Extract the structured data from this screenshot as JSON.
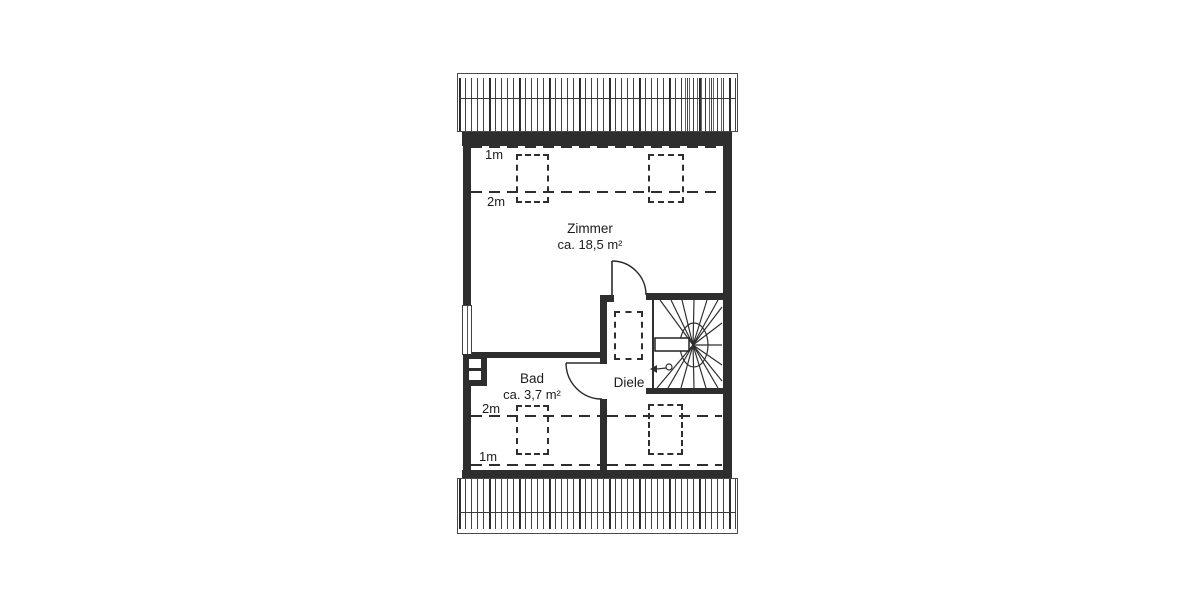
{
  "plan": {
    "type": "floor-plan",
    "rooms": {
      "zimmer": {
        "name": "Zimmer",
        "area": "ca. 18,5 m²"
      },
      "bad": {
        "name": "Bad",
        "area": "ca. 3,7 m²"
      },
      "diele": {
        "name": "Diele"
      }
    },
    "height_markers": {
      "top_1m": "1m",
      "top_2m": "2m",
      "bottom_2m": "2m",
      "bottom_1m": "1m"
    }
  },
  "colors": {
    "wall": "#2e2e2e",
    "line": "#333333",
    "background": "#ffffff",
    "text": "#1c1c1c"
  }
}
